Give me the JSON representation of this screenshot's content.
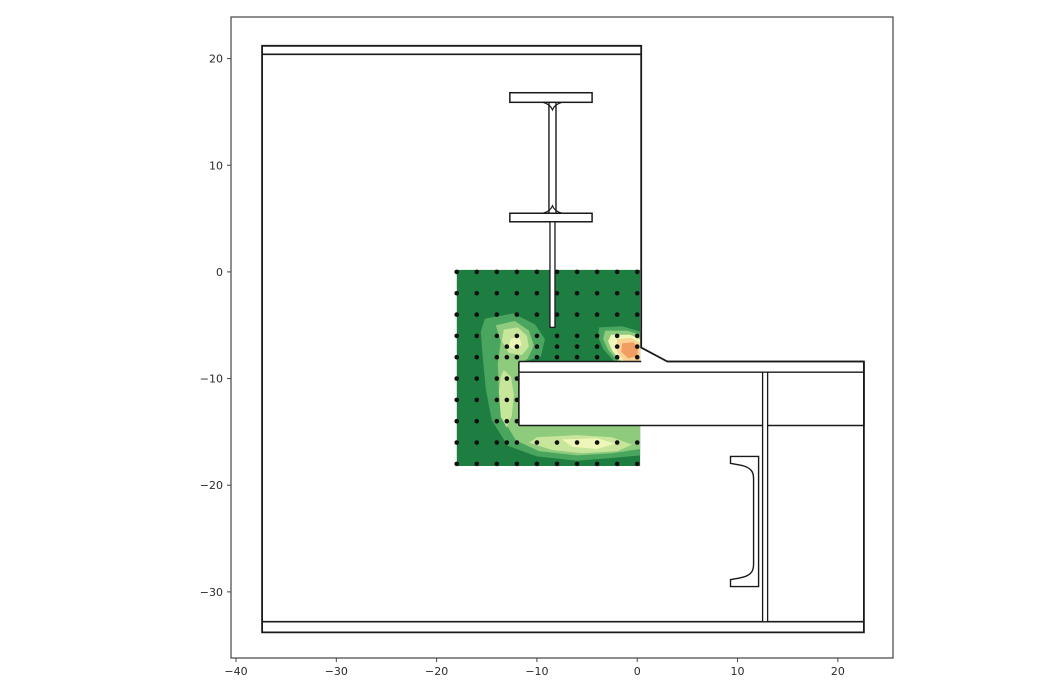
{
  "figure": {
    "background": "#ffffff",
    "width": 1050,
    "height": 700
  },
  "chart_data": {
    "type": "contour",
    "title": "",
    "xlabel": "",
    "ylabel": "",
    "xlim": [
      -40.5,
      25.5
    ],
    "ylim": [
      -36.2,
      23.9
    ],
    "xticks": [
      -40,
      -30,
      -20,
      -10,
      0,
      10,
      20
    ],
    "yticks": [
      20,
      10,
      0,
      -10,
      -20,
      -30
    ],
    "xtick_labels": [
      "−40",
      "−30",
      "−20",
      "−10",
      "0",
      "10",
      "20"
    ],
    "ytick_labels": [
      "20",
      "10",
      "0",
      "−10",
      "−20",
      "−30"
    ],
    "grid": false,
    "legend": "none",
    "axes_style": {
      "frame_color": "#444444",
      "tick_color": "#444444",
      "tick_label_color": "#2b2b2b",
      "tick_font_size": 11
    },
    "contour": {
      "x_range": [
        -18.0,
        0.3
      ],
      "y_range": [
        -18.2,
        0.2
      ],
      "base_color": "#1e7e41",
      "level_colors": [
        "#4aa65f",
        "#8ecb7c",
        "#c8e69b",
        "#eef7b8",
        "#fad394",
        "#f29e63"
      ],
      "blobs": [
        {
          "level": 1,
          "color": "#4aa65f",
          "name": "c-band-around-notch",
          "points": [
            [
              -15.2,
              -4.4
            ],
            [
              -12.4,
              -3.9
            ],
            [
              -10.2,
              -4.9
            ],
            [
              -9.2,
              -6.3
            ],
            [
              -9.6,
              -7.9
            ],
            [
              -11.8,
              -8.6
            ],
            [
              -11.8,
              -14.4
            ],
            [
              0.3,
              -14.4
            ],
            [
              0.3,
              -17.2
            ],
            [
              -2.0,
              -17.4
            ],
            [
              -6.0,
              -17.7
            ],
            [
              -10.0,
              -17.3
            ],
            [
              -12.9,
              -16.3
            ],
            [
              -14.5,
              -13.9
            ],
            [
              -15.1,
              -11.0
            ],
            [
              -15.4,
              -8.0
            ],
            [
              -15.6,
              -5.6
            ]
          ]
        },
        {
          "level": 1,
          "color": "#4aa65f",
          "name": "hotspot-outer",
          "points": [
            [
              -3.8,
              -5.2
            ],
            [
              -1.5,
              -5.1
            ],
            [
              0.3,
              -5.6
            ],
            [
              0.3,
              -8.4
            ],
            [
              -2.3,
              -8.4
            ],
            [
              -3.4,
              -7.2
            ],
            [
              -3.9,
              -6.1
            ]
          ]
        },
        {
          "level": 2,
          "color": "#8ecb7c",
          "name": "light-band",
          "points": [
            [
              -14.1,
              -5.0
            ],
            [
              -12.2,
              -4.6
            ],
            [
              -10.8,
              -5.5
            ],
            [
              -10.3,
              -6.9
            ],
            [
              -10.9,
              -8.1
            ],
            [
              -11.8,
              -8.7
            ],
            [
              -11.8,
              -14.4
            ],
            [
              0.3,
              -14.4
            ],
            [
              0.3,
              -16.6
            ],
            [
              -2.5,
              -17.0
            ],
            [
              -6.0,
              -17.2
            ],
            [
              -9.8,
              -16.8
            ],
            [
              -12.1,
              -15.8
            ],
            [
              -13.3,
              -13.9
            ],
            [
              -13.8,
              -11.0
            ],
            [
              -13.9,
              -8.6
            ],
            [
              -13.6,
              -6.5
            ]
          ]
        },
        {
          "level": 2,
          "color": "#8ecb7c",
          "name": "hotspot-light-ring",
          "points": [
            [
              -3.2,
              -5.5
            ],
            [
              -1.0,
              -5.5
            ],
            [
              0.3,
              -5.9
            ],
            [
              0.3,
              -8.4
            ],
            [
              -1.9,
              -8.4
            ],
            [
              -2.9,
              -7.3
            ],
            [
              -3.4,
              -6.3
            ]
          ]
        },
        {
          "level": 3,
          "color": "#c8e69b",
          "name": "upper-lobe-core",
          "points": [
            [
              -13.3,
              -5.4
            ],
            [
              -11.9,
              -5.2
            ],
            [
              -11.0,
              -6.0
            ],
            [
              -10.8,
              -7.0
            ],
            [
              -11.5,
              -7.8
            ],
            [
              -12.8,
              -7.6
            ],
            [
              -13.5,
              -6.5
            ]
          ]
        },
        {
          "level": 3,
          "color": "#c8e69b",
          "name": "left-band-core",
          "points": [
            [
              -13.3,
              -9.2
            ],
            [
              -12.6,
              -9.8
            ],
            [
              -12.3,
              -11.5
            ],
            [
              -12.5,
              -13.5
            ],
            [
              -13.0,
              -14.6
            ],
            [
              -13.6,
              -13.6
            ],
            [
              -13.8,
              -11.2
            ],
            [
              -13.6,
              -9.8
            ]
          ]
        },
        {
          "level": 3,
          "color": "#c8e69b",
          "name": "bottom-band-core",
          "points": [
            [
              -10.0,
              -15.5
            ],
            [
              -6.0,
              -15.3
            ],
            [
              -2.5,
              -15.5
            ],
            [
              -0.5,
              -16.2
            ],
            [
              -2.0,
              -16.8
            ],
            [
              -5.5,
              -17.0
            ],
            [
              -8.5,
              -16.7
            ],
            [
              -10.8,
              -16.0
            ]
          ]
        },
        {
          "level": 4,
          "color": "#eef7b8",
          "name": "bottom-cream",
          "points": [
            [
              -7.5,
              -15.7
            ],
            [
              -4.0,
              -15.6
            ],
            [
              -2.2,
              -16.1
            ],
            [
              -4.0,
              -16.6
            ],
            [
              -6.5,
              -16.4
            ]
          ]
        },
        {
          "level": 4,
          "color": "#eef7b8",
          "name": "upper-lobe-cream-dot",
          "points": [
            [
              -12.6,
              -6.3
            ],
            [
              -11.8,
              -6.1
            ],
            [
              -11.5,
              -6.8
            ],
            [
              -12.1,
              -7.3
            ],
            [
              -12.8,
              -7.0
            ]
          ]
        },
        {
          "level": 4,
          "color": "#eef7b8",
          "name": "hotspot-cream",
          "points": [
            [
              -2.6,
              -5.9
            ],
            [
              -0.7,
              -5.9
            ],
            [
              0.3,
              -6.3
            ],
            [
              0.3,
              -8.4
            ],
            [
              -1.6,
              -8.4
            ],
            [
              -2.5,
              -7.4
            ],
            [
              -2.9,
              -6.5
            ]
          ]
        },
        {
          "level": 5,
          "color": "#fad394",
          "name": "hotspot-peach",
          "points": [
            [
              -2.0,
              -6.3
            ],
            [
              -0.6,
              -6.2
            ],
            [
              0.3,
              -6.7
            ],
            [
              0.3,
              -8.4
            ],
            [
              -1.3,
              -8.4
            ],
            [
              -2.0,
              -7.5
            ]
          ]
        },
        {
          "level": 6,
          "color": "#f29e63",
          "name": "hotspot-orange-core",
          "points": [
            [
              -1.5,
              -6.7
            ],
            [
              -0.4,
              -6.6
            ],
            [
              0.1,
              -7.1
            ],
            [
              0.0,
              -7.9
            ],
            [
              -0.9,
              -8.1
            ],
            [
              -1.6,
              -7.5
            ]
          ]
        }
      ]
    },
    "scatter": {
      "marker": "dot",
      "color": "#111111",
      "radius_px": 2.3,
      "rows": [
        {
          "y": 0,
          "x": [
            -18,
            -16,
            -14,
            -12,
            -10,
            -8,
            -6,
            -4,
            -2,
            0
          ]
        },
        {
          "y": -2,
          "x": [
            -18,
            -16,
            -14,
            -12,
            -10,
            -8,
            -6,
            -4,
            -2,
            0
          ]
        },
        {
          "y": -4,
          "x": [
            -18,
            -16,
            -14,
            -12,
            -10,
            -8,
            -6,
            -4,
            -2,
            0
          ]
        },
        {
          "y": -6,
          "x": [
            -18,
            -16,
            -14,
            -12,
            -10,
            -8,
            -6,
            -4,
            -2,
            0
          ]
        },
        {
          "y": -7,
          "x": [
            -13,
            -12,
            -10,
            -8,
            -6,
            -4,
            -2,
            0
          ]
        },
        {
          "y": -8,
          "x": [
            -18,
            -16,
            -14,
            -13,
            -12,
            -10,
            -8,
            -6,
            -4,
            -2,
            0
          ]
        },
        {
          "y": -10,
          "x": [
            -18,
            -16,
            -14,
            -13,
            -12
          ]
        },
        {
          "y": -12,
          "x": [
            -18,
            -16,
            -14,
            -13,
            -12
          ]
        },
        {
          "y": -14,
          "x": [
            -18,
            -16,
            -14,
            -13,
            -12
          ]
        },
        {
          "y": -16,
          "x": [
            -18,
            -16,
            -14,
            -13,
            -12,
            -10,
            -8,
            -6,
            -4,
            -2,
            0
          ]
        },
        {
          "y": -18,
          "x": [
            -18,
            -16,
            -14,
            -12,
            -10,
            -8,
            -6,
            -4,
            -2,
            0
          ]
        }
      ]
    },
    "drawing": {
      "line_color": "#1a1a1a",
      "specimen_outline": [
        [
          -37.4,
          21.2
        ],
        [
          0.4,
          21.2
        ],
        [
          0.4,
          -7.1
        ],
        [
          3.0,
          -8.4
        ],
        [
          22.6,
          -8.4
        ],
        [
          22.6,
          -33.8
        ],
        [
          -37.4,
          -33.8
        ]
      ],
      "top_plate_line": {
        "y": 20.4,
        "x1": -37.4,
        "x2": 0.4
      },
      "bottom_plate_line": {
        "y": -32.8,
        "x1": -37.4,
        "x2": 22.6
      },
      "beam_band": {
        "x1": -11.8,
        "x2": 22.6,
        "y_top": -8.4,
        "y_bottom": -14.4,
        "chamfer_gap": [
          0.4,
          3.0
        ]
      },
      "beam_second_line": {
        "y": -9.4,
        "x1": -11.8,
        "x2": 22.6
      },
      "i_beam": {
        "flange_x": [
          -12.7,
          -4.5
        ],
        "top_flange_y": [
          16.8,
          15.9
        ],
        "bottom_flange_y": [
          5.5,
          4.7
        ],
        "web_x": [
          -8.8,
          -8.1
        ]
      },
      "embedded_plate": {
        "x": [
          -8.7,
          -8.2
        ],
        "y": [
          4.7,
          -5.2
        ]
      },
      "web_plate": {
        "x": [
          12.5,
          13.0
        ],
        "y": [
          -9.4,
          -32.8
        ]
      },
      "channel": {
        "web_x": [
          11.6,
          12.1
        ],
        "tip_x": 9.3,
        "top_y": -17.3,
        "bottom_y": -29.5,
        "flange_tip_ys": [
          -17.95,
          -28.85
        ]
      }
    }
  }
}
